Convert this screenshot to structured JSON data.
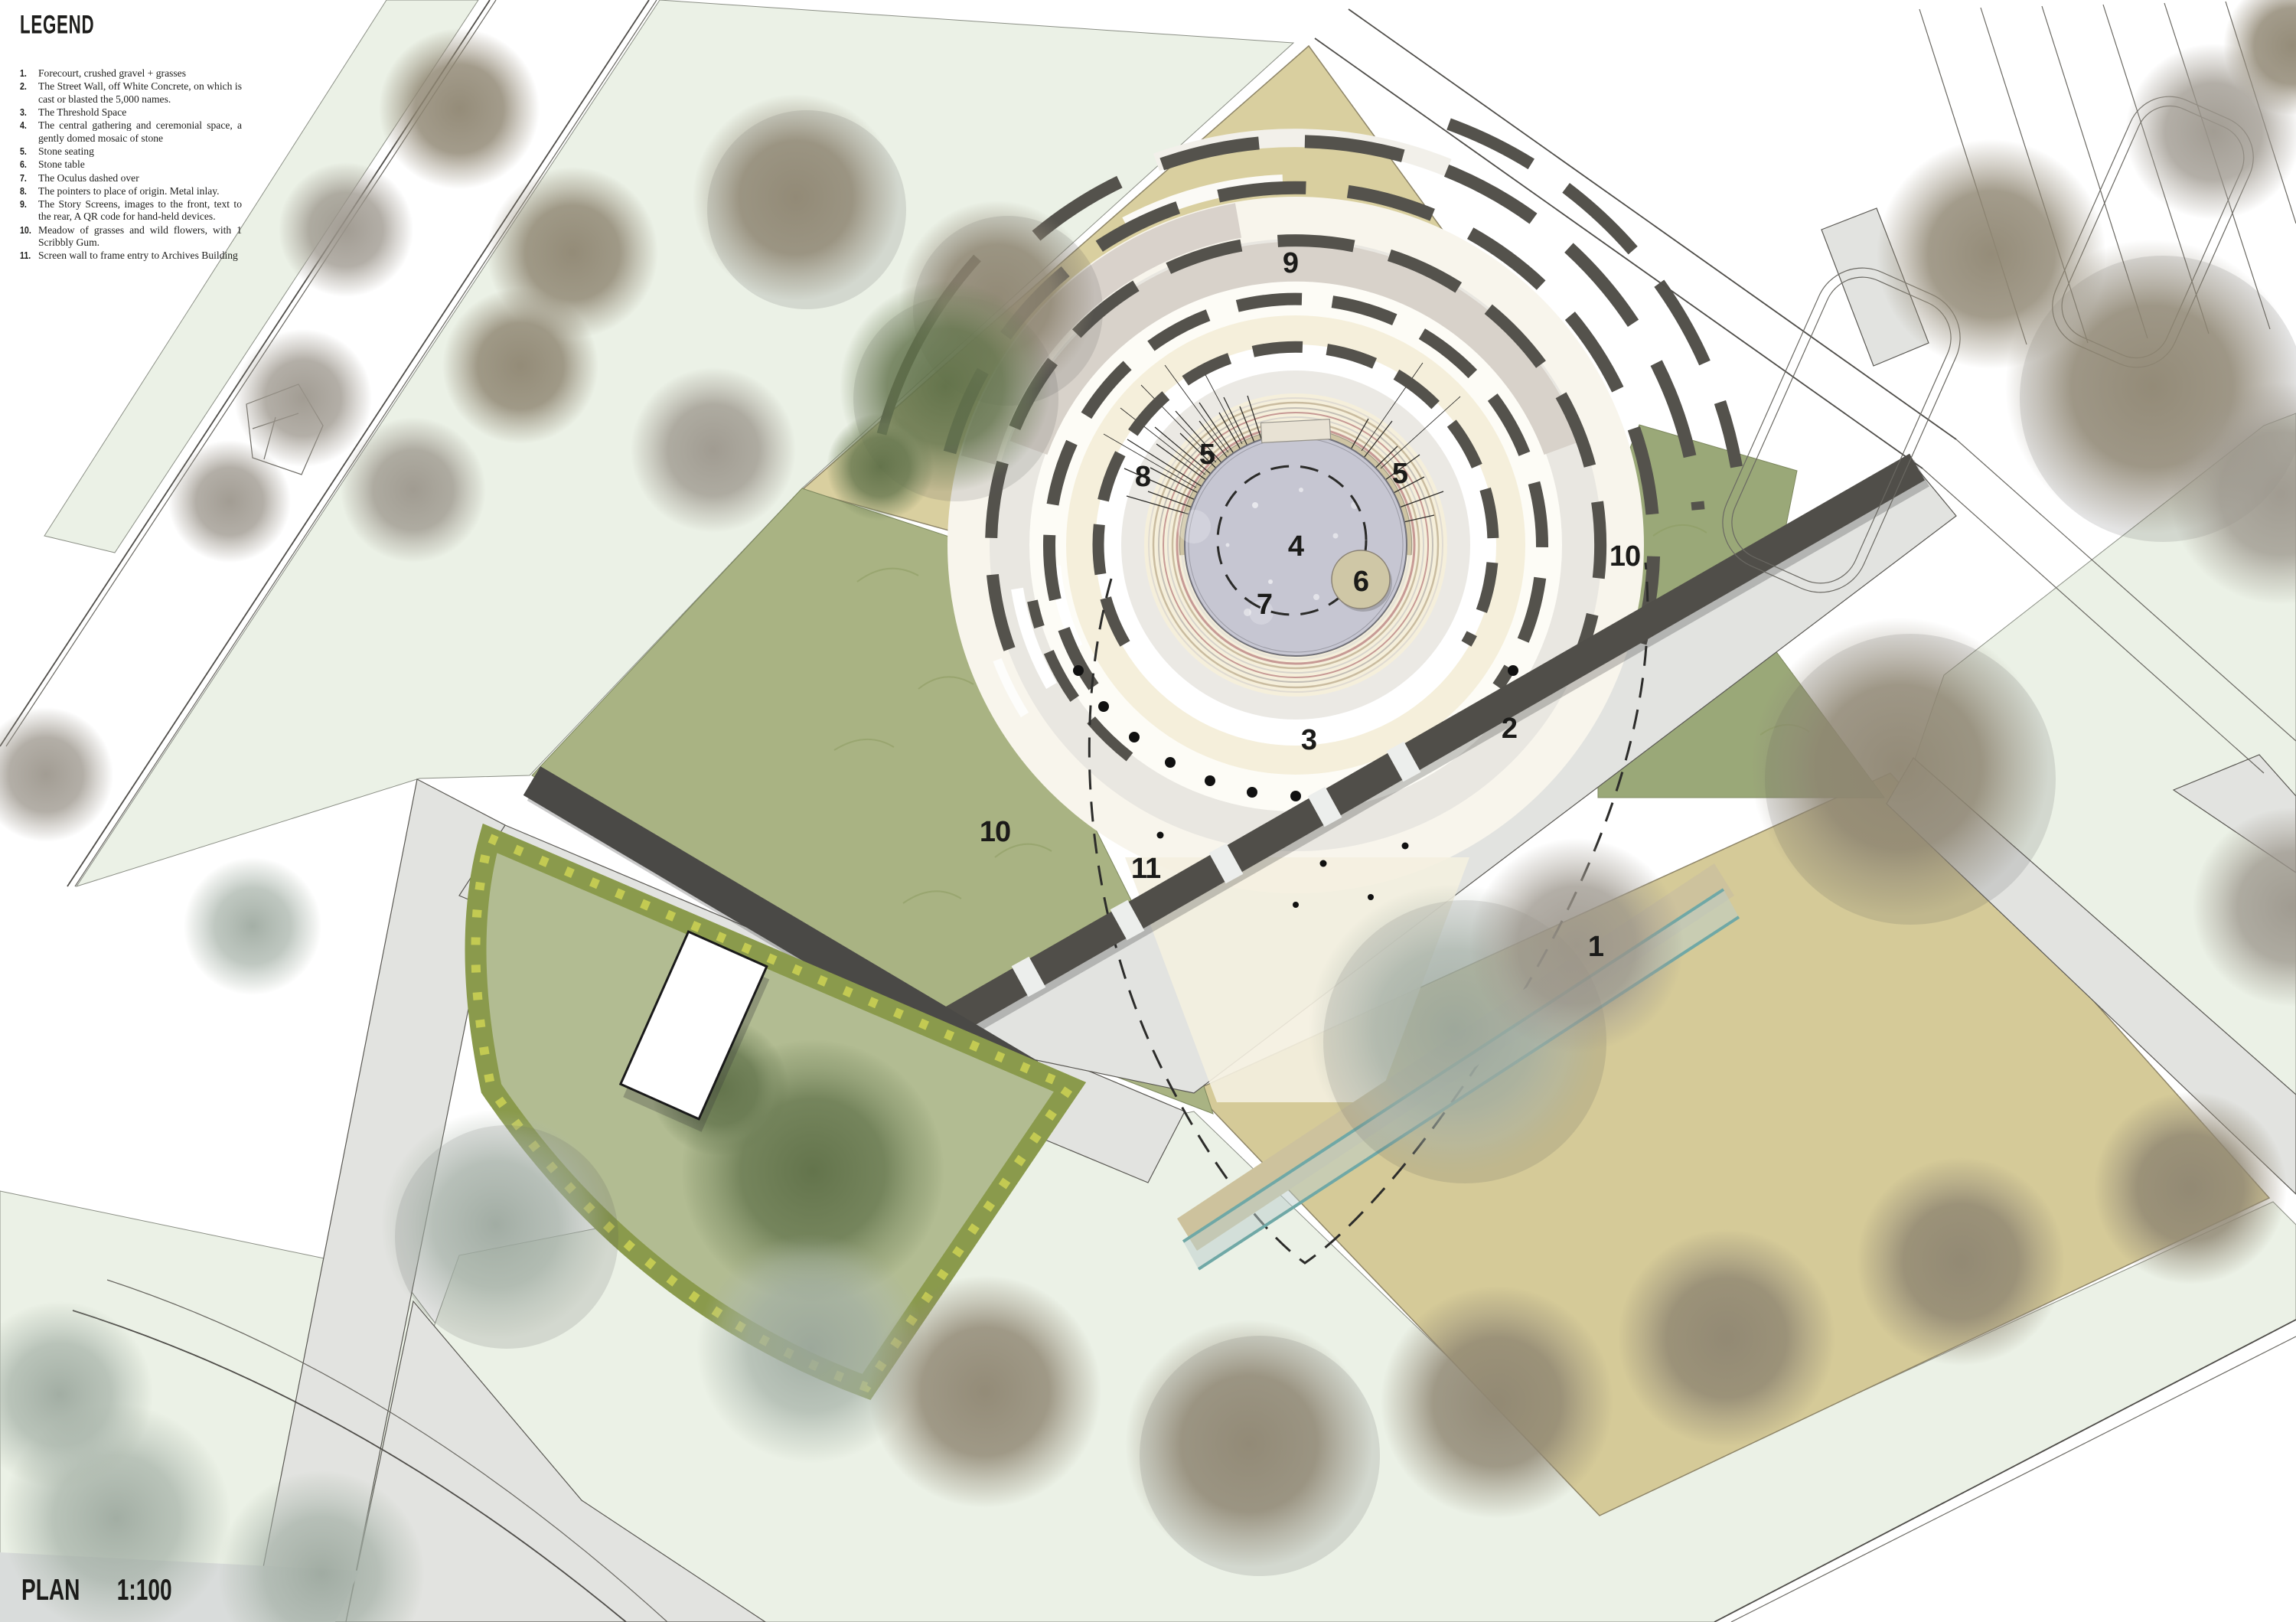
{
  "legend": {
    "title": "LEGEND",
    "items": [
      {
        "num": "1.",
        "text": "Forecourt, crushed gravel + grasses"
      },
      {
        "num": "2.",
        "text": "The Street Wall, off White Concrete, on which is cast or blasted the 5,000 names."
      },
      {
        "num": "3.",
        "text": "The Threshold Space"
      },
      {
        "num": "4.",
        "text": "The central gathering and ceremonial space, a gently domed mosaic of stone"
      },
      {
        "num": "5.",
        "text": "Stone seating"
      },
      {
        "num": "6.",
        "text": "Stone table"
      },
      {
        "num": "7.",
        "text": "The Oculus dashed over"
      },
      {
        "num": "8.",
        "text": "The pointers to place of origin. Metal inlay."
      },
      {
        "num": "9.",
        "text": "The Story Screens, images to the front, text to the rear, A QR code for hand-held devices."
      },
      {
        "num": "10.",
        "text": "Meadow of grasses and wild flowers, with 1 Scribbly Gum."
      },
      {
        "num": "11.",
        "text": "Screen wall to frame entry to Archives Building"
      }
    ]
  },
  "plan": {
    "name": "PLAN",
    "scale": "1:100",
    "callouts": [
      {
        "num": "9"
      },
      {
        "num": "8"
      },
      {
        "num": "5"
      },
      {
        "num": "5"
      },
      {
        "num": "4"
      },
      {
        "num": "6"
      },
      {
        "num": "7"
      },
      {
        "num": "3"
      },
      {
        "num": "2"
      },
      {
        "num": "10"
      },
      {
        "num": "11"
      },
      {
        "num": "1"
      },
      {
        "num": "10"
      }
    ]
  },
  "colors": {
    "forecourt": "#d9cf9f",
    "forecourt_dark": "#d5ca98",
    "meadow": "#a9b383",
    "strip_green": "#9aa878",
    "lawn": "#ebf1e6",
    "road": "#e2e3e0",
    "wall_dark": "#504e49",
    "screen_dark": "#54524c",
    "seat_stone": "#cec4a3",
    "mosaic": "#c6c6d2",
    "table_stone": "#cfc7a6",
    "ring_cream": "#f5efdb",
    "ring_white": "#fdfcf6",
    "ring_gray": "#e9e7e1",
    "band_beige": "#d8d2ca",
    "hedge": "#8a9a4c",
    "garden_grass": "#b2bc92",
    "glass": "#6fa8a6",
    "ink": "#1b1b19"
  }
}
